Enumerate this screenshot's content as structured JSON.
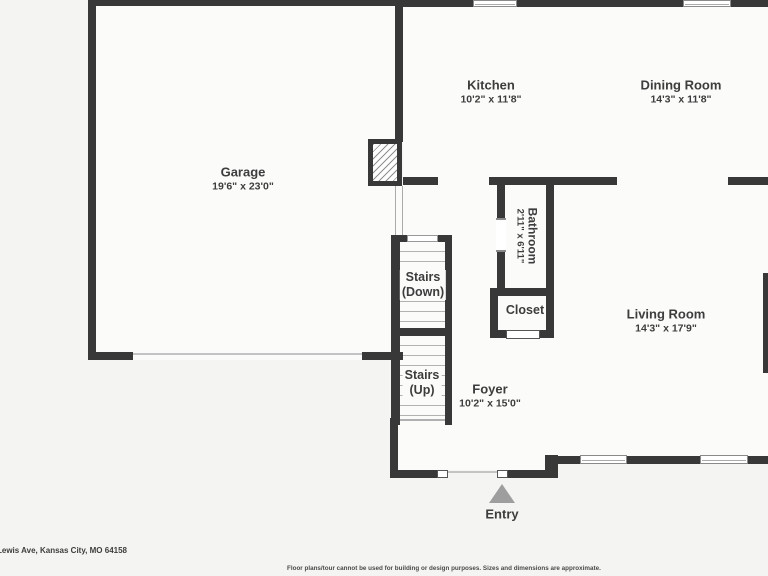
{
  "rooms": {
    "garage": {
      "name": "Garage",
      "dims": "19'6\" x 23'0\""
    },
    "kitchen": {
      "name": "Kitchen",
      "dims": "10'2\" x 11'8\""
    },
    "dining_room": {
      "name": "Dining Room",
      "dims": "14'3\" x 11'8\""
    },
    "bathroom": {
      "name": "Bathroom",
      "dims": "2'11\" x 6'11\""
    },
    "closet": {
      "name": "Closet"
    },
    "living_room": {
      "name": "Living Room",
      "dims": "14'3\" x 17'9\""
    },
    "foyer": {
      "name": "Foyer",
      "dims": "10'2\" x 15'0\""
    }
  },
  "stairs": {
    "down": {
      "line1": "Stairs",
      "line2": "(Down)"
    },
    "up": {
      "line1": "Stairs",
      "line2": "(Up)"
    }
  },
  "entry": {
    "label": "Entry"
  },
  "footer": {
    "address": "Lewis Ave, Kansas City, MO 64158",
    "disclaimer": "Floor plans/tour cannot be used for building or design purposes. Sizes and dimensions are approximate."
  },
  "colors": {
    "wall": "#383838",
    "background": "#f4f4f2",
    "floor": "#fbfbfa",
    "text": "#3d3d3d",
    "entry_arrow": "#9e9e9e"
  }
}
